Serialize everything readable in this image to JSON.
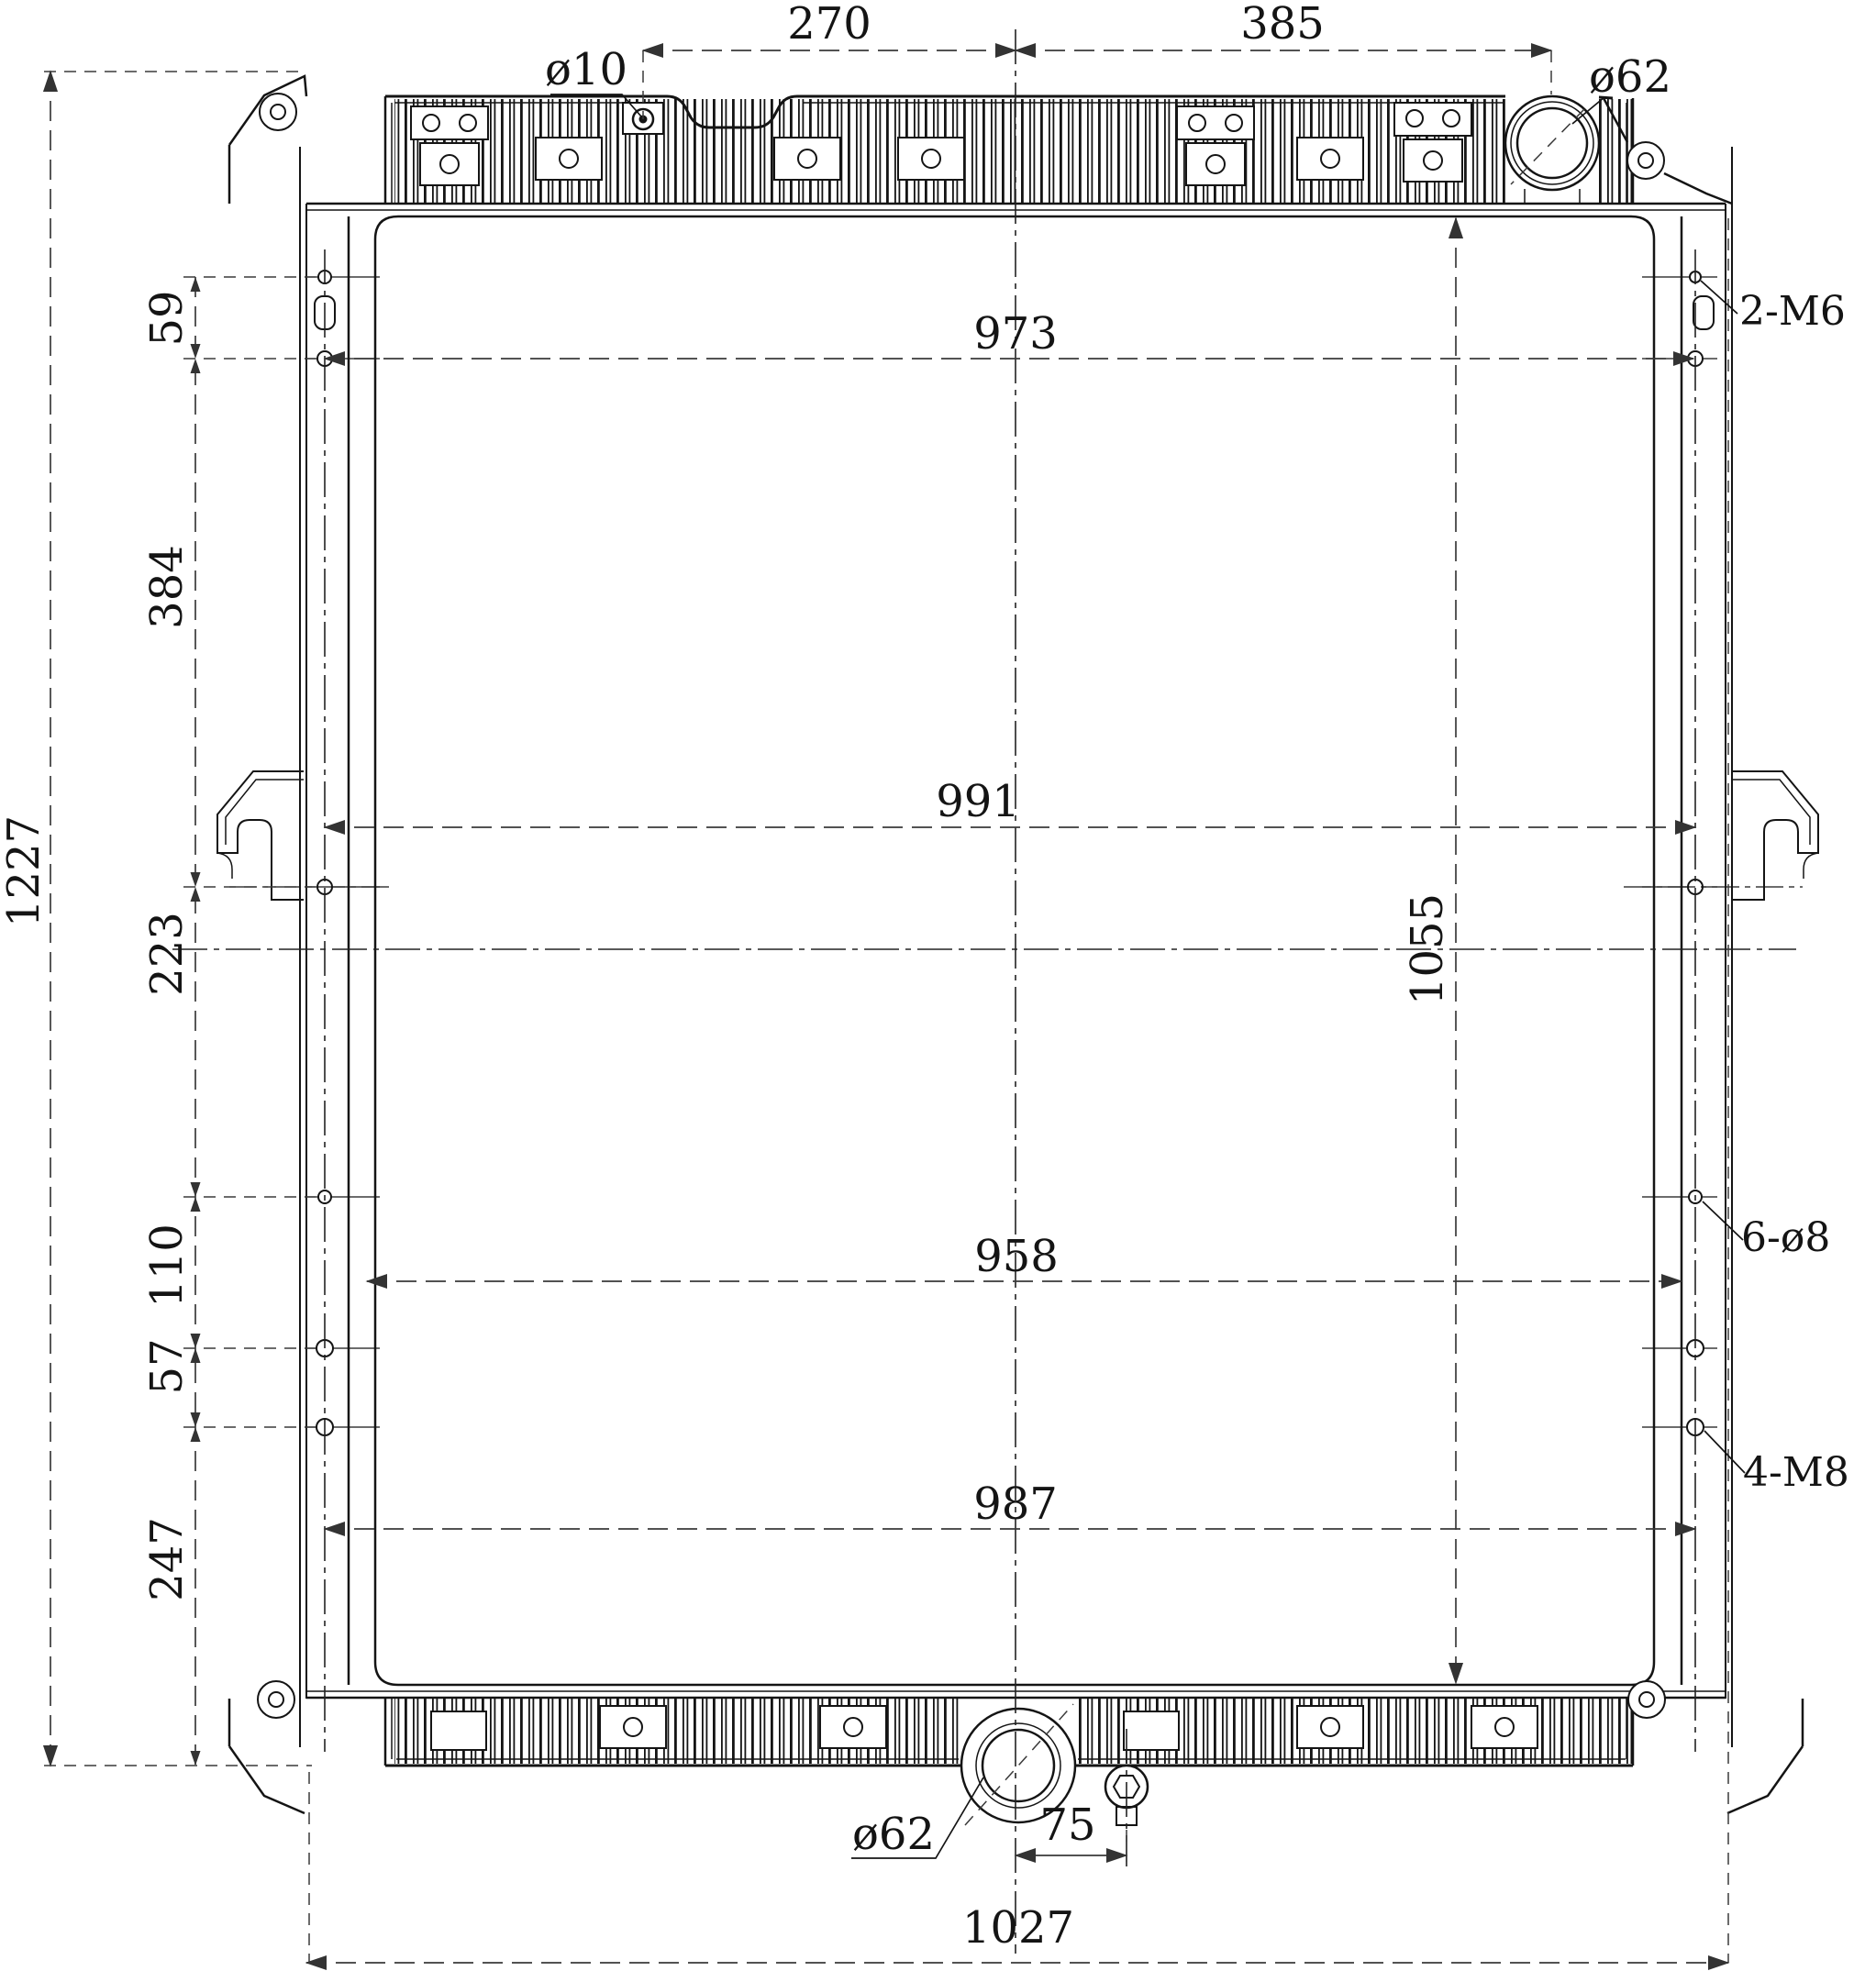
{
  "drawing": {
    "title": "radiator-front-view-engineering-drawing",
    "units": "mm",
    "background": "#ffffff",
    "line_color": "#141414",
    "dim_color": "#3a3a3a",
    "dims": {
      "top_offset_left": "270",
      "top_offset_right": "385",
      "top_hole": "ø10",
      "inlet": "ø62",
      "width_top": "973",
      "hole_gap_top": "59",
      "upper_span": "384",
      "overall_height": "1227",
      "mid_span": "223",
      "hole_gap_mid": "110",
      "hole_gap_low": "57",
      "bottom_span": "247",
      "width_mid": "991",
      "core_height": "1055",
      "width_low": "958",
      "width_bottom": "987",
      "thread_top_right": "2-M6",
      "holes_right": "6-ø8",
      "thread_bottom_right": "4-M8",
      "outlet": "ø62",
      "drain_offset": "75",
      "overall_width": "1027"
    }
  }
}
